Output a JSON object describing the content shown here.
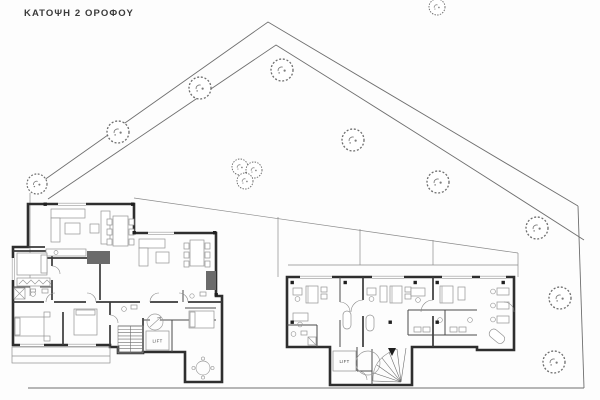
{
  "title": "ΚΑΤΟΨΗ 2 ΟΡΟΦΟΥ",
  "labels": {
    "left_building_lift": "LIFT",
    "right_building_lift": "LIFT"
  },
  "drawing": {
    "type": "architectural-floor-plan",
    "floor_shown": 2,
    "building_count": 2,
    "colors": {
      "background": "#fdfdfd",
      "walls": "#2e2e2e",
      "site_lines": "#6f6f6f",
      "furniture_lines": "#929292",
      "tree_outline": "#6e6e6e",
      "title_text": "#3a3a3a"
    },
    "trees": [
      {
        "x": 437,
        "y": 7,
        "r": 8
      },
      {
        "x": 282,
        "y": 70,
        "r": 11
      },
      {
        "x": 200,
        "y": 88,
        "r": 11
      },
      {
        "x": 118,
        "y": 132,
        "r": 11
      },
      {
        "x": 37,
        "y": 184,
        "r": 10
      },
      {
        "x": 240,
        "y": 167,
        "r": 8
      },
      {
        "x": 254,
        "y": 170,
        "r": 8
      },
      {
        "x": 245,
        "y": 181,
        "r": 8
      },
      {
        "x": 353,
        "y": 140,
        "r": 11
      },
      {
        "x": 438,
        "y": 182,
        "r": 11
      },
      {
        "x": 537,
        "y": 228,
        "r": 11
      },
      {
        "x": 560,
        "y": 298,
        "r": 11
      },
      {
        "x": 554,
        "y": 362,
        "r": 11
      }
    ]
  }
}
